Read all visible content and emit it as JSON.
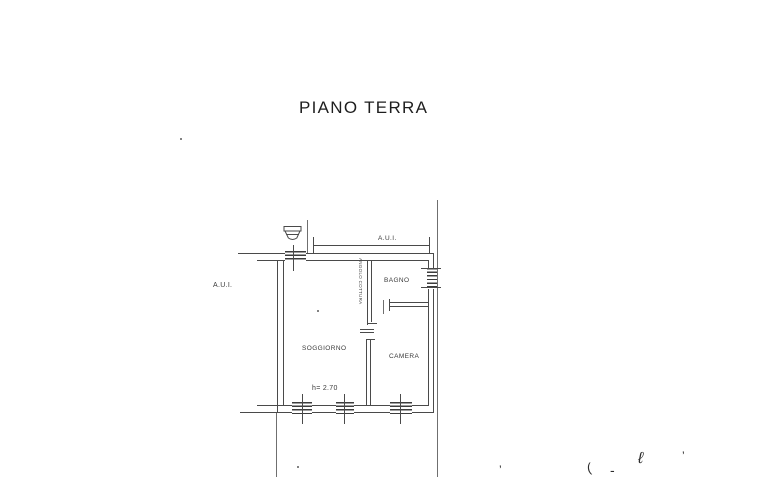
{
  "title": "PIANO TERRA",
  "plan": {
    "aui_top_label": "A.U.I.",
    "aui_left_label": "A.U.I.",
    "rooms": {
      "soggiorno": "SOGGIORNO",
      "camera": "CAMERA",
      "bagno": "BAGNO",
      "angolo_cottura": "ANGOLO COTTURA"
    },
    "height_note": "h= 2.70"
  },
  "colors": {
    "wall_line": "#4a4a4a",
    "light_line": "#6f6f6f",
    "text": "#3a3a3a",
    "background": "#ffffff"
  },
  "scan_marks": {
    "m1": "’",
    "m2": "(",
    "m3": "-",
    "m4": "ℓ",
    "m5": "’"
  }
}
